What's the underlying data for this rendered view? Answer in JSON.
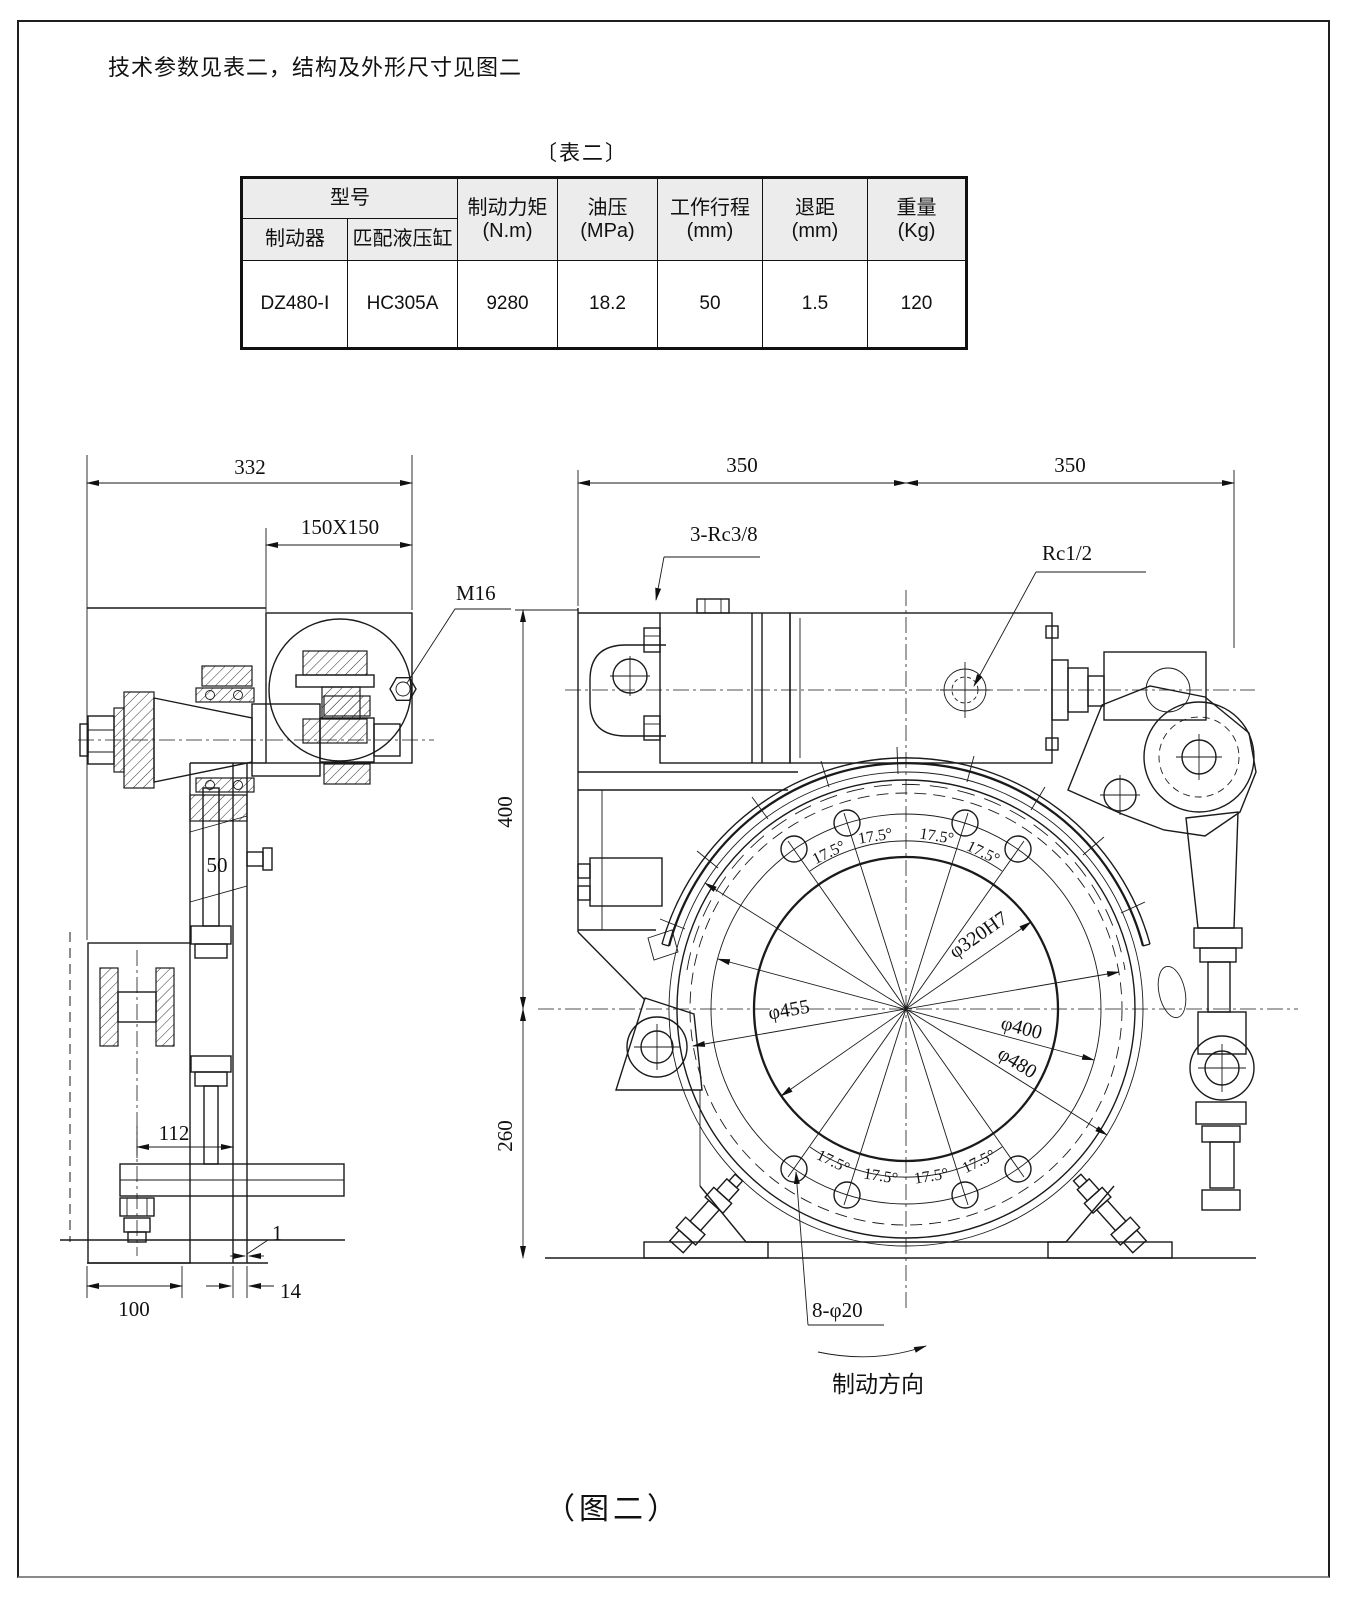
{
  "colors": {
    "line": "#1a1a1a",
    "table_header_bg": "#ececec",
    "paper": "#ffffff"
  },
  "page": {
    "intro_text": "技术参数见表二，结构及外形尺寸见图二",
    "table_caption": "〔表二〕",
    "figure_caption": "（图二）"
  },
  "table": {
    "header": {
      "model_group": "型号",
      "brake": "制动器",
      "matched_cylinder": "匹配液压缸",
      "torque_label": "制动力矩",
      "torque_unit": "(N.m)",
      "pressure_label": "油压",
      "pressure_unit": "(MPa)",
      "stroke_label": "工作行程",
      "stroke_unit": "(mm)",
      "retreat_label": "退距",
      "retreat_unit": "(mm)",
      "weight_label": "重量",
      "weight_unit": "(Kg)"
    },
    "row": {
      "brake_model": "DZ480-Ⅰ",
      "cylinder_model": "HC305A",
      "torque": "9280",
      "pressure": "18.2",
      "stroke": "50",
      "retreat": "1.5",
      "weight": "120"
    }
  },
  "side_view": {
    "overall_width": "332",
    "plate_size": "150X150",
    "thread": "M16",
    "arm_width": "50",
    "hole_pitch": "112",
    "base_width": "100",
    "gap": "1",
    "plate_thickness": "14"
  },
  "front_view": {
    "span_left": "350",
    "span_right": "350",
    "height_upper": "400",
    "height_lower": "260",
    "ports": "3-Rc3/8",
    "port": "Rc1/2",
    "bolt_holes": "8-φ20",
    "bore_dia": "φ320H7",
    "bolt_circle_dia": "φ400",
    "lining_dia": "φ455",
    "outer_dia": "φ480",
    "hole_angle": "17.5°",
    "direction_label": "制动方向"
  }
}
